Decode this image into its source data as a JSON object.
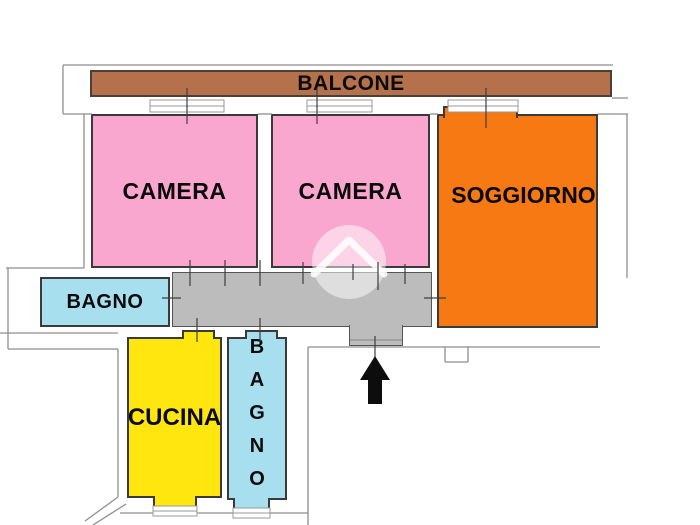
{
  "floorplan": {
    "balcone": {
      "label": "BALCONE",
      "color": "#b5714b"
    },
    "camera_1": {
      "label": "CAMERA",
      "color": "#faa7cf"
    },
    "camera_2": {
      "label": "CAMERA",
      "color": "#faa7cf"
    },
    "soggiorno": {
      "label": "SOGGIORNO",
      "color": "#f67913"
    },
    "bagno_1": {
      "label": "BAGNO",
      "color": "#a8dfee"
    },
    "cucina": {
      "label": "CUCINA",
      "color": "#ffe60f"
    },
    "bagno_2": {
      "label": "BAGNO",
      "color": "#a8dfee"
    },
    "corridoio": {
      "label": "",
      "color": "#bcbcbc"
    },
    "entrance": {
      "icon": "up-arrow-icon",
      "color": "#0d0d0d"
    },
    "watermark": {
      "icon": "house-watermark-icon"
    },
    "wall_color": "#3a3a3a",
    "outline_color": "#8e8e8e"
  }
}
